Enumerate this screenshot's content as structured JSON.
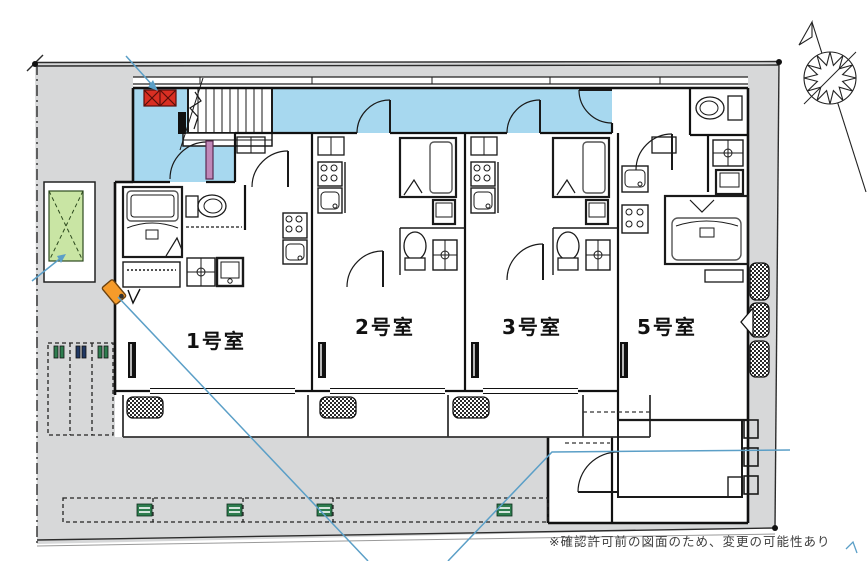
{
  "drawing": {
    "kind": "apartment-floor-plan",
    "note": "※確認許可前の図面のため、変更の可能性あり"
  },
  "rooms": [
    {
      "id": "room-1",
      "label": "1号室"
    },
    {
      "id": "room-2",
      "label": "2号室"
    },
    {
      "id": "room-3",
      "label": "3号室"
    },
    {
      "id": "room-5",
      "label": "5号室"
    }
  ],
  "site": {
    "bicycle_stall_count": 3,
    "car_stall_marker_count": 4,
    "outdoor_unit_count_right": 3
  },
  "colors": {
    "site_gray": "#d7d8d9",
    "corridor_blue": "#a7d8ef",
    "alert_red": "#d92f23",
    "planting_green": "#c9e5a4",
    "camera_orange": "#f59b2a",
    "annotation_blue": "#5b9fc7",
    "marker_green": "#2e7d4f",
    "marker_navy": "#203864",
    "door_purple": "#c088b8"
  }
}
